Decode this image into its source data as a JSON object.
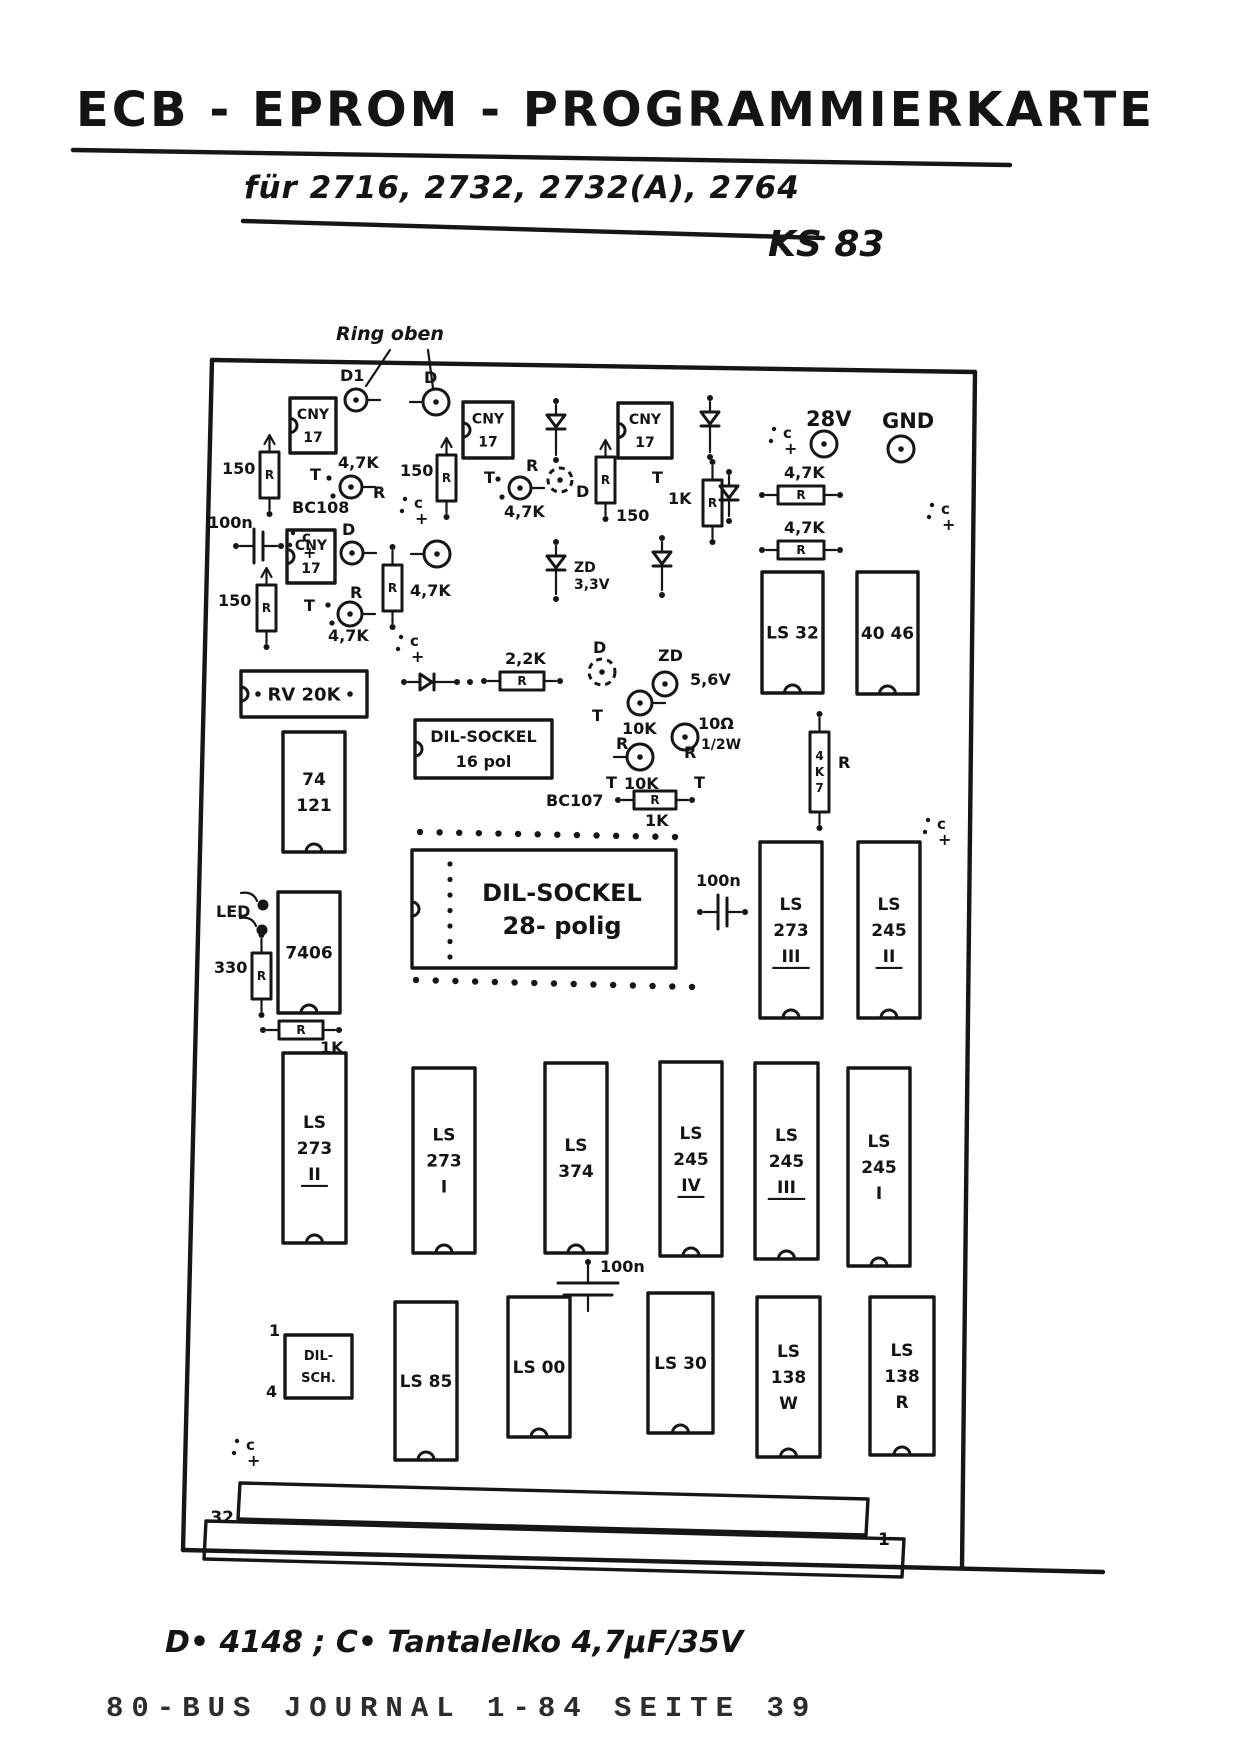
{
  "page": {
    "title": "ECB - EPROM - PROGRAMMIERKARTE",
    "subtitle": "für 2716, 2732, 2732(A), 2764",
    "code": "KS 83",
    "ring_note": "Ring oben",
    "footnote": "D• 4148 ;   C• Tantalelko 4,7µF/35V",
    "journal": "80-BUS JOURNAL 1-84 SEITE 39"
  },
  "board": {
    "pin_left": "32",
    "pin_right": "1"
  },
  "colors": {
    "ink": "#161616",
    "paper": "#ffffff",
    "journal_ink": "#2d2d2d"
  },
  "components": {
    "boxes": [
      {
        "name": "opto-cny17-1",
        "x": 290,
        "y": 398,
        "w": 46,
        "h": 55,
        "lines": [
          "CNY",
          "17"
        ],
        "fs": 14,
        "tab": 1
      },
      {
        "name": "opto-cny17-2",
        "x": 463,
        "y": 402,
        "w": 50,
        "h": 56,
        "lines": [
          "CNY",
          "17"
        ],
        "fs": 14,
        "tab": 1
      },
      {
        "name": "opto-cny17-3",
        "x": 618,
        "y": 403,
        "w": 54,
        "h": 55,
        "lines": [
          "CNY",
          "17"
        ],
        "fs": 14,
        "tab": 1
      },
      {
        "name": "opto-cny17-4",
        "x": 287,
        "y": 530,
        "w": 48,
        "h": 53,
        "lines": [
          "CNY",
          "17"
        ],
        "fs": 14,
        "tab": 1
      },
      {
        "name": "ic-ls32",
        "x": 762,
        "y": 572,
        "w": 61,
        "h": 121,
        "lines": [
          "LS 32"
        ],
        "notch": 1
      },
      {
        "name": "ic-4046",
        "x": 857,
        "y": 572,
        "w": 61,
        "h": 122,
        "lines": [
          "40 46"
        ],
        "notch": 1
      },
      {
        "name": "pot-rv20k",
        "x": 241,
        "y": 671,
        "w": 126,
        "h": 46,
        "lines": [
          "RV 20K"
        ],
        "fs": 18,
        "dots": 1,
        "tab": 1
      },
      {
        "name": "ic-74121",
        "x": 283,
        "y": 732,
        "w": 62,
        "h": 120,
        "lines": [
          "74",
          "121"
        ],
        "notch": 1
      },
      {
        "name": "socket-dil16",
        "x": 415,
        "y": 720,
        "w": 137,
        "h": 58,
        "lines": [
          "DIL-SOCKEL",
          "16 pol"
        ],
        "fs": 16,
        "tab": 1
      },
      {
        "name": "ic-7406",
        "x": 278,
        "y": 892,
        "w": 62,
        "h": 121,
        "lines": [
          "7406"
        ],
        "notch": 1
      },
      {
        "name": "socket-dil28",
        "x": 412,
        "y": 850,
        "w": 264,
        "h": 118,
        "lines": [
          "DIL-SOCKEL",
          "28- polig"
        ],
        "fs": 24,
        "tab": 1,
        "pincol": 1,
        "lxo": 18
      },
      {
        "name": "ic-ls273-iii",
        "x": 760,
        "y": 842,
        "w": 62,
        "h": 176,
        "lines": [
          "LS",
          "273",
          "III"
        ],
        "ul": 2,
        "notch": 1
      },
      {
        "name": "ic-ls245-ii",
        "x": 858,
        "y": 842,
        "w": 62,
        "h": 176,
        "lines": [
          "LS",
          "245",
          "II"
        ],
        "ul": 2,
        "notch": 1
      },
      {
        "name": "ic-ls273-ii",
        "x": 283,
        "y": 1053,
        "w": 63,
        "h": 190,
        "lines": [
          "LS",
          "273",
          "II"
        ],
        "ul": 2,
        "notch": 1
      },
      {
        "name": "ic-ls273-i",
        "x": 413,
        "y": 1068,
        "w": 62,
        "h": 185,
        "lines": [
          "LS",
          "273",
          "I"
        ],
        "notch": 1
      },
      {
        "name": "ic-ls374",
        "x": 545,
        "y": 1063,
        "w": 62,
        "h": 190,
        "lines": [
          "LS",
          "374"
        ],
        "notch": 1
      },
      {
        "name": "ic-ls245-iv",
        "x": 660,
        "y": 1062,
        "w": 62,
        "h": 194,
        "lines": [
          "LS",
          "245",
          "IV"
        ],
        "ul": 2,
        "notch": 1
      },
      {
        "name": "ic-ls245-iii",
        "x": 755,
        "y": 1063,
        "w": 63,
        "h": 196,
        "lines": [
          "LS",
          "245",
          "III"
        ],
        "ul": 2,
        "notch": 1
      },
      {
        "name": "ic-ls245-i",
        "x": 848,
        "y": 1068,
        "w": 62,
        "h": 198,
        "lines": [
          "LS",
          "245",
          "I"
        ],
        "notch": 1
      },
      {
        "name": "switch-dil-sch",
        "x": 285,
        "y": 1335,
        "w": 67,
        "h": 63,
        "lines": [
          "DIL-",
          "SCH."
        ],
        "fs": 13
      },
      {
        "name": "ic-ls85",
        "x": 395,
        "y": 1302,
        "w": 62,
        "h": 158,
        "lines": [
          "LS 85"
        ],
        "notch": 1
      },
      {
        "name": "ic-ls00",
        "x": 508,
        "y": 1297,
        "w": 62,
        "h": 140,
        "lines": [
          "LS 00"
        ],
        "notch": 1
      },
      {
        "name": "ic-ls30",
        "x": 648,
        "y": 1293,
        "w": 65,
        "h": 140,
        "lines": [
          "LS 30"
        ],
        "notch": 1
      },
      {
        "name": "ic-ls138w",
        "x": 757,
        "y": 1297,
        "w": 63,
        "h": 160,
        "lines": [
          "LS",
          "138",
          "W"
        ],
        "notch": 1
      },
      {
        "name": "ic-ls138r",
        "x": 870,
        "y": 1297,
        "w": 64,
        "h": 158,
        "lines": [
          "LS",
          "138",
          "R"
        ],
        "notch": 1
      }
    ],
    "vres": [
      {
        "name": "res-150-1",
        "x": 260,
        "y": 452,
        "label": "150",
        "lx": 222,
        "ly": 474,
        "arrow": 1
      },
      {
        "name": "res-150-2",
        "x": 437,
        "y": 455,
        "label": "150",
        "lx": 400,
        "ly": 476,
        "arrow": 1
      },
      {
        "name": "res-150-3",
        "x": 596,
        "y": 457,
        "label": "150",
        "lx": 616,
        "ly": 521,
        "arrow": 1
      },
      {
        "name": "res-1k",
        "x": 703,
        "y": 480,
        "label": "1K",
        "lx": 668,
        "ly": 504
      },
      {
        "name": "res-4k7-v",
        "x": 383,
        "y": 565,
        "label": "4,7K",
        "lx": 410,
        "ly": 596
      },
      {
        "name": "res-150-4",
        "x": 257,
        "y": 585,
        "label": "150",
        "lx": 218,
        "ly": 606,
        "arrow": 1
      },
      {
        "name": "res-4k7-tall",
        "x": 810,
        "y": 732,
        "h": 80,
        "inner": [
          "4",
          "K",
          "7"
        ],
        "label2": "R",
        "l2x": 838,
        "l2y": 768
      },
      {
        "name": "res-330",
        "x": 252,
        "y": 953,
        "label": "330",
        "lx": 214,
        "ly": 973
      }
    ],
    "hres": [
      {
        "name": "res-4k7-h1",
        "x": 778,
        "y": 486,
        "w": 46,
        "label": "4,7K",
        "lx": 784,
        "ly": 478
      },
      {
        "name": "res-4k7-h2",
        "x": 778,
        "y": 541,
        "w": 46,
        "label": "4,7K",
        "lx": 784,
        "ly": 533
      },
      {
        "name": "res-2k2",
        "x": 500,
        "y": 672,
        "w": 44,
        "label": "2,2K",
        "lx": 505,
        "ly": 664
      },
      {
        "name": "res-1k-bc107",
        "x": 634,
        "y": 791,
        "w": 42,
        "label": "1K",
        "lx": 645,
        "ly": 826
      },
      {
        "name": "res-1k-7406",
        "x": 279,
        "y": 1021,
        "w": 44,
        "label": "1K",
        "lx": 320,
        "ly": 1053
      }
    ],
    "circles": [
      {
        "name": "diode-d1",
        "cx": 356,
        "cy": 400,
        "r": 11,
        "label": "D1",
        "lx": 340,
        "ly": 381,
        "lead": "r"
      },
      {
        "name": "diode-d2",
        "cx": 436,
        "cy": 402,
        "r": 13,
        "label": "D",
        "lx": 424,
        "ly": 383,
        "lead": "l"
      },
      {
        "name": "transistor-bc108",
        "cx": 351,
        "cy": 487,
        "r": 11,
        "lead": "r",
        "holes": 1
      },
      {
        "name": "transistor-2",
        "cx": 520,
        "cy": 488,
        "r": 11,
        "lead": "r",
        "holes": 1
      },
      {
        "name": "diode-d3",
        "cx": 352,
        "cy": 553,
        "r": 11,
        "label": "D",
        "lx": 342,
        "ly": 535,
        "lead": "r"
      },
      {
        "name": "diode-d4",
        "cx": 437,
        "cy": 554,
        "r": 13,
        "lead": "l"
      },
      {
        "name": "transistor-3",
        "cx": 350,
        "cy": 614,
        "r": 12,
        "lead": "r",
        "holes": 1
      },
      {
        "name": "diode-dash-1",
        "cx": 560,
        "cy": 480,
        "r": 12,
        "dash": 1
      },
      {
        "name": "diode-dash-2",
        "cx": 602,
        "cy": 672,
        "r": 13,
        "dash": 1
      },
      {
        "name": "transistor-10k-1",
        "cx": 640,
        "cy": 703,
        "r": 12,
        "lead": "r"
      },
      {
        "name": "transistor-10k-2",
        "cx": 640,
        "cy": 757,
        "r": 13,
        "lead": "l"
      },
      {
        "name": "zener-5v6",
        "cx": 665,
        "cy": 684,
        "r": 12
      },
      {
        "name": "res-10ohm",
        "cx": 685,
        "cy": 737,
        "r": 13
      },
      {
        "name": "terminal-28v",
        "cx": 824,
        "cy": 444,
        "r": 13,
        "term": 1
      },
      {
        "name": "terminal-gnd",
        "cx": 901,
        "cy": 449,
        "r": 13,
        "term": 1
      }
    ],
    "diodes": [
      {
        "name": "diode-v1",
        "x": 556,
        "y": 415,
        "len": 26
      },
      {
        "name": "diode-v2",
        "x": 710,
        "y": 412,
        "len": 26
      },
      {
        "name": "diode-v3",
        "x": 729,
        "y": 486,
        "len": 16
      },
      {
        "name": "zener-3v3",
        "x": 556,
        "y": 556,
        "len": 24
      },
      {
        "name": "diode-v4",
        "x": 662,
        "y": 552,
        "len": 24
      },
      {
        "name": "diode-h1",
        "x": 420,
        "y": 682,
        "len": 22,
        "horiz": 1
      }
    ],
    "caps": [
      {
        "name": "cap-100n-left",
        "kind": "vbars",
        "x": 254,
        "y": 546,
        "label": "100n",
        "lx": 208,
        "ly": 528
      },
      {
        "name": "cap-100n-mid",
        "kind": "vbars",
        "x": 718,
        "y": 912,
        "label": "100n",
        "lx": 696,
        "ly": 886
      },
      {
        "name": "cap-100n-bottom",
        "kind": "hplates",
        "x": 588,
        "y": 1283,
        "label": "100n",
        "lx": 600,
        "ly": 1272
      }
    ],
    "dot_rows": [
      {
        "name": "pin-row-top",
        "x0": 420,
        "y0": 832,
        "x1": 675,
        "y1": 837,
        "n": 14
      },
      {
        "name": "pin-row-bottom",
        "x0": 416,
        "y0": 980,
        "x1": 692,
        "y1": 987,
        "n": 15
      }
    ],
    "stray_dots": [
      [
        457,
        682
      ],
      [
        470,
        682
      ],
      [
        588,
        1262
      ]
    ],
    "cmarks": [
      [
        783,
        438
      ],
      [
        941,
        514
      ],
      [
        937,
        829
      ],
      [
        302,
        542
      ],
      [
        414,
        508
      ],
      [
        410,
        646
      ],
      [
        246,
        1450
      ]
    ],
    "led": {
      "label": "LED",
      "lx": 216,
      "ly": 917,
      "dots": [
        [
          263,
          905
        ],
        [
          262,
          930
        ]
      ]
    },
    "labels": [
      {
        "t": "28V",
        "x": 806,
        "y": 426,
        "fs": 21
      },
      {
        "t": "GND",
        "x": 882,
        "y": 428,
        "fs": 21
      },
      {
        "t": "T",
        "x": 310,
        "y": 480
      },
      {
        "t": "T",
        "x": 484,
        "y": 483
      },
      {
        "t": "T",
        "x": 652,
        "y": 483
      },
      {
        "t": "T",
        "x": 304,
        "y": 611
      },
      {
        "t": "T",
        "x": 592,
        "y": 721
      },
      {
        "t": "T",
        "x": 606,
        "y": 788
      },
      {
        "t": "T",
        "x": 694,
        "y": 788
      },
      {
        "t": "R",
        "x": 373,
        "y": 498
      },
      {
        "t": "R",
        "x": 526,
        "y": 471
      },
      {
        "t": "R",
        "x": 350,
        "y": 598
      },
      {
        "t": "R",
        "x": 616,
        "y": 749
      },
      {
        "t": "R",
        "x": 684,
        "y": 758
      },
      {
        "t": "4,7K",
        "x": 338,
        "y": 468
      },
      {
        "t": "4,7K",
        "x": 504,
        "y": 517
      },
      {
        "t": "4,7K",
        "x": 328,
        "y": 641
      },
      {
        "t": "BC108",
        "x": 292,
        "y": 513
      },
      {
        "t": "BC107",
        "x": 546,
        "y": 806
      },
      {
        "t": "10K",
        "x": 622,
        "y": 734
      },
      {
        "t": "10K",
        "x": 624,
        "y": 789
      },
      {
        "t": "ZD",
        "x": 658,
        "y": 661
      },
      {
        "t": "5,6V",
        "x": 690,
        "y": 685
      },
      {
        "t": "ZD",
        "x": 574,
        "y": 572,
        "fs": 14
      },
      {
        "t": "3,3V",
        "x": 574,
        "y": 589,
        "fs": 14
      },
      {
        "t": "D",
        "x": 576,
        "y": 497
      },
      {
        "t": "D",
        "x": 593,
        "y": 653
      },
      {
        "t": "10Ω",
        "x": 698,
        "y": 729
      },
      {
        "t": "1/2W",
        "x": 701,
        "y": 749,
        "fs": 14
      },
      {
        "t": "1",
        "x": 269,
        "y": 1336
      },
      {
        "t": "4",
        "x": 266,
        "y": 1397
      }
    ]
  }
}
